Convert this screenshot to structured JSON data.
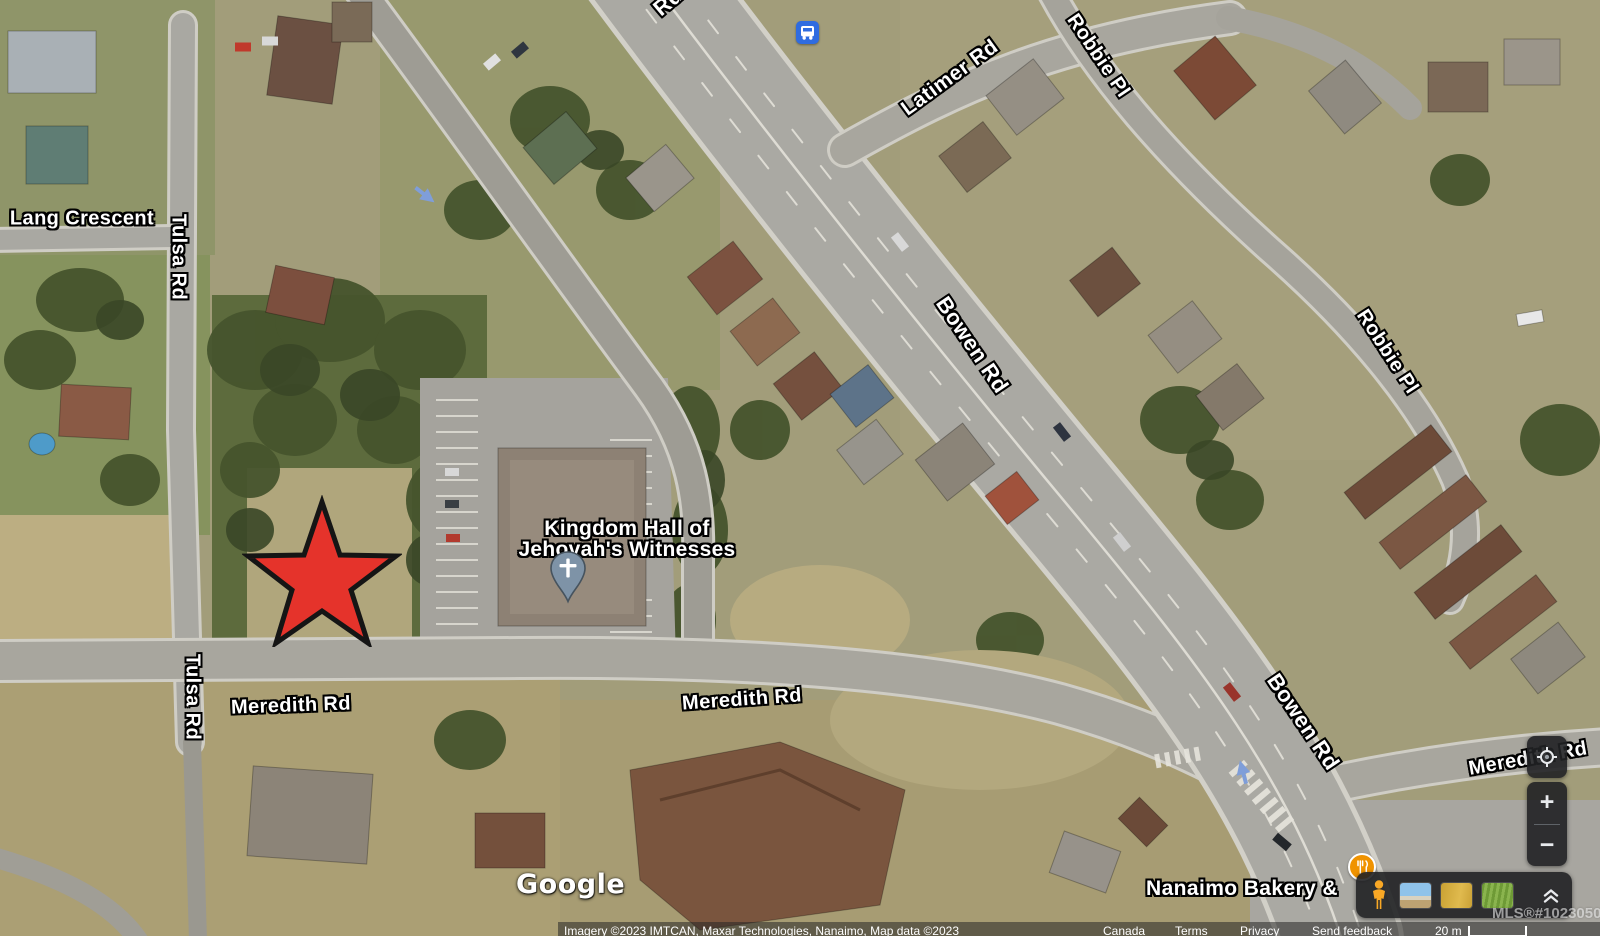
{
  "map_labels": {
    "partial_road": "Rd",
    "latimer": "Latimer Rd",
    "robbie_top": "Robbie Pl",
    "robbie_mid": "Robbie Pl",
    "bowen_upper": "Bowen Rd",
    "bowen_lower": "Bowen Rd",
    "lang_crescent": "Lang Crescent",
    "tulsa_upper": "Tulsa Rd",
    "tulsa_lower": "Tulsa Rd",
    "meredith_left": "Meredith Rd",
    "meredith_center": "Meredith Rd",
    "meredith_right": "Meredith Rd"
  },
  "pois": {
    "kingdom_hall": {
      "line1": "Kingdom Hall of",
      "line2": "Jehovah's Witnesses",
      "icon": "church-cross-pin"
    },
    "bakery": {
      "label": "Nanaimo Bakery &",
      "icon": "restaurant-utensils-icon"
    },
    "bus_stop": {
      "icon": "bus-transit-icon"
    }
  },
  "annotation": {
    "shape": "red-star",
    "fill": "#E5332B",
    "outline": "#141414"
  },
  "branding": {
    "logo": "Google"
  },
  "watermark": "MLS®#1023050",
  "attribution": {
    "imagery": "Imagery ©2023 IMTCAN, Maxar Technologies, Nanaimo, Map data ©2023",
    "links": [
      "Canada",
      "Terms",
      "Privacy",
      "Send feedback"
    ],
    "scale_label": "20 m"
  },
  "controls": {
    "my_location_icon": "crosshair-target-icon",
    "zoom_in": "+",
    "zoom_out": "−",
    "pegman_icon": "street-view-pegman-icon",
    "collapse_icon": "double-chevron-up-icon",
    "thumbnails": [
      "coastline-imagery-thumbnail",
      "golden-field-imagery-thumbnail",
      "green-field-imagery-thumbnail"
    ]
  },
  "colors": {
    "star_red": "#E5332B",
    "transit_blue": "#2F6CE0",
    "poi_orange": "#F09300",
    "pin_slate": "#7E93A7",
    "panel_dark": "#202124",
    "label_white": "#FFFFFF"
  }
}
